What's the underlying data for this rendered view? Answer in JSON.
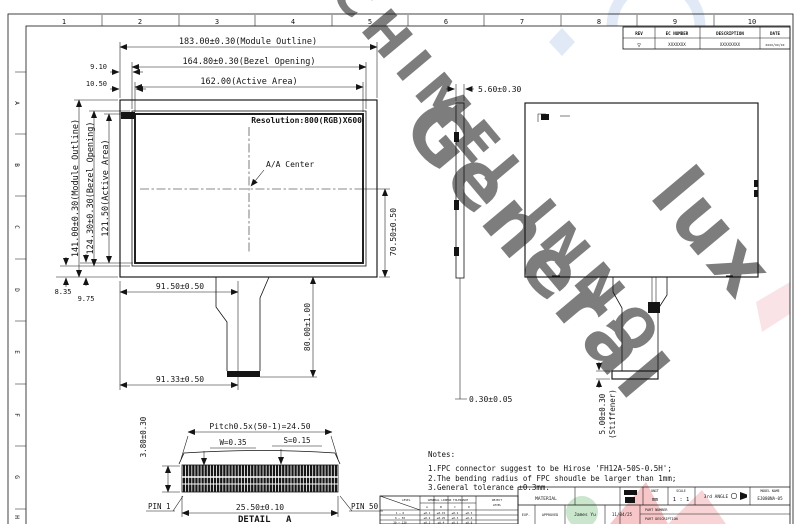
{
  "sheet": {
    "columns": [
      "1",
      "2",
      "3",
      "4",
      "5",
      "6",
      "7",
      "8",
      "9",
      "10"
    ],
    "rows": [
      "A",
      "B",
      "C",
      "D",
      "E",
      "F",
      "G",
      "H"
    ]
  },
  "revision_table": {
    "headers": [
      "REV",
      "EC NUMBER",
      "DESCRIPTION",
      "DATE"
    ],
    "rev_symbol": "▽",
    "ec_number": "XXXXXXX",
    "description": "XXXXXXXX",
    "date": "xxxx/xx/xx"
  },
  "front_view": {
    "dim_module_w": "183.00±0.30(Module Outline)",
    "dim_bezel_w": "164.80±0.30(Bezel Opening)",
    "dim_active_w": "162.00(Active Area)",
    "dim_offset_left_bezel": "9.10",
    "dim_offset_left_active": "10.50",
    "dim_module_h": "141.00±0.30(Module Outline)",
    "dim_bezel_h": "124.30±0.30(Bezel Opening)",
    "dim_active_h": "121.50(Active Area)",
    "dim_offset_bottom_bezel": "8.35",
    "dim_offset_bottom_active": "9.75",
    "resolution": "Resolution:800(RGB)X600",
    "aa_center_label": "A/A Center",
    "dim_center_to_bottom": "70.50±0.50",
    "dim_fpc_center_x": "91.50±0.50",
    "dim_fpc_length": "80.00±1.00",
    "dim_fpc_end_x": "91.33±0.50"
  },
  "side_view": {
    "dim_thickness": "5.60±0.30",
    "dim_fpc_thickness": "0.30±0.05"
  },
  "rear_view": {
    "dim_stiffener": "5.00±0.30",
    "dim_stiffener_note": "(Stiffener)"
  },
  "detail_a": {
    "dim_pitch": "Pitch0.5x(50-1)=24.50",
    "dim_w": "W=0.35",
    "dim_s": "S=0.15",
    "dim_height": "3.80±0.30",
    "pin_first": "PIN 1",
    "pin_last": "PIN 50",
    "dim_width": "25.50±0.10",
    "title_word": "DETAIL",
    "title_letter": "A"
  },
  "notes": {
    "title": "Notes:",
    "lines": [
      "1.FPC connector suggest to be Hirose 'FH12A-50S-0.5H';",
      "2.The bending radius of FPC shoudle be larger than 1mm;",
      "3.General tolerance ±0.3mm."
    ]
  },
  "tolerance_table": {
    "level_label": "LEVEL",
    "header": "GENERAL LINEAR TOLERANCE",
    "reject_label1": "REJECT",
    "reject_label2": "LEVEL",
    "sub_cols": [
      "A",
      "B",
      "C",
      "D"
    ],
    "rows": [
      [
        "1 ~ 6",
        "±0.1",
        "±0.15",
        "±0.2",
        "±0.3"
      ],
      [
        "6 ~ 30",
        "±0.2",
        "±0.25",
        "±0.3",
        "±0.4"
      ],
      [
        "30 ~ 120",
        "±0.3",
        "±0.4",
        "±0.5",
        "±0.8"
      ]
    ]
  },
  "title_block": {
    "material_label": "MATERIAL",
    "exp_label": "EXP.",
    "approved_label": "APPROVED",
    "approved_name": "James Yu",
    "approved_date": "11/04/25",
    "unit_label": "UNIT",
    "unit_value": "mm",
    "scale_label": "SCALE",
    "scale_value": "1 : 1",
    "angle_label": "3rd ANGLE",
    "model_label": "MODEL NAME",
    "model_value": "EJ080NA-05",
    "part_number_label": "PART NUMBER",
    "part_description_label": "PART DESCRIPTION"
  },
  "watermark": {
    "text_top": "CHIMEI INNO",
    "text_mid": "General",
    "text_right": "lux"
  }
}
